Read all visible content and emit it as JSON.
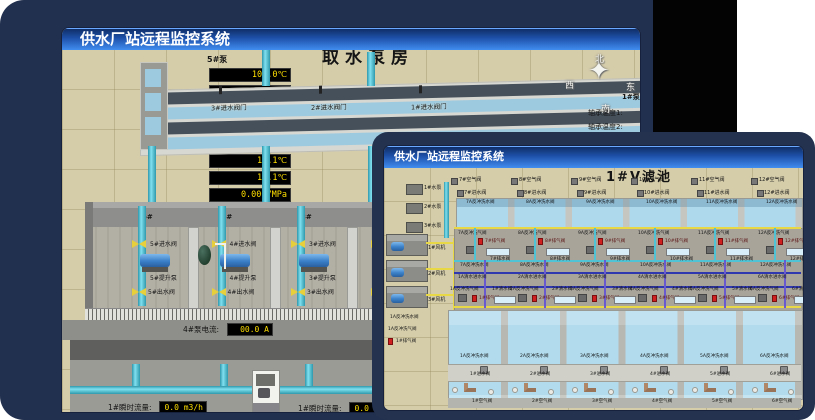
{
  "colors": {
    "desktop_card": "#22304f",
    "black_panel": "#030303",
    "titlebar_top": "#0e2a60",
    "titlebar_bottom": "#418df0",
    "scene_tan": "#d5cdaa",
    "led_text": "#ffdf00",
    "pipe_cyan": "#5bc8d8",
    "valve_yellow": "#e6cf3a",
    "valve_red": "#d02020",
    "pump_blue": "#3a80c8",
    "water": "#b4dcec"
  },
  "back_window": {
    "titlebar": "供水厂站远程监控系统",
    "scene_title": "取水泵房",
    "pump5_panel": {
      "title": "5#泵",
      "rows": [
        {
          "label": "轴承温度1:",
          "value": "100.0℃"
        },
        {
          "label": "轴承温度2:",
          "value": "100.0℃"
        },
        {
          "label": "电机温度1:",
          "value": "18.1℃"
        },
        {
          "label": "电机温度2:",
          "value": "17.9℃"
        },
        {
          "label": "绕组温度1:",
          "value": "18.0℃"
        },
        {
          "label": "绕组温度2:",
          "value": "18.1℃"
        },
        {
          "label": "绕组温度3:",
          "value": "18.1℃"
        },
        {
          "label": "管道压力:",
          "value": "0.0007MPa"
        },
        {
          "label": "多功能阀:",
          "value": "0%"
        }
      ]
    },
    "compass": {
      "n": "北",
      "w": "西",
      "s": "南",
      "e": "东"
    },
    "pump1_panel_partial": {
      "title": "1#泵",
      "row1": "轴承温度1:",
      "row2": "轴承温度2:"
    },
    "inlet_gates": [
      {
        "label": "3#进水阀门"
      },
      {
        "label": "2#进水阀门"
      },
      {
        "label": "1#进水阀门"
      }
    ],
    "bays": [
      {
        "num": "5#",
        "inlet": "5#进水阀",
        "pump": "5#提升泵",
        "outlet": "5#出水阀"
      },
      {
        "num": "4#",
        "inlet": "4#进水阀",
        "pump": "4#提升泵",
        "outlet": "4#出水阀"
      },
      {
        "num": "3#",
        "inlet": "3#进水阀",
        "pump": "3#提升泵",
        "outlet": "3#出水阀"
      },
      {
        "num": "2#",
        "inlet": "2#进水阀",
        "pump": "2#提升泵",
        "outlet": "2#出水阀"
      }
    ],
    "meters": {
      "pump4_current_label": "4#泵电流:",
      "pump4_current_value": "00.0 A",
      "pump2_current_label": "2#泵电流:",
      "pump2_current_value": "00.0 A",
      "flow_left_label": "1#瞬时流量:",
      "flow_left_value": "0.0 m3/h",
      "flow_right_label": "1#瞬时流量:",
      "flow_right_value": "0.0 m3/h"
    }
  },
  "front_window": {
    "titlebar": "供水厂站远程监控系统",
    "scene_title": "1#V滤池",
    "left_pumps": [
      {
        "label": "1#水泵"
      },
      {
        "label": "2#水泵"
      },
      {
        "label": "3#水泵"
      }
    ],
    "left_blowers": [
      {
        "label": "1#风机"
      },
      {
        "label": "2#风机"
      },
      {
        "label": "3#风机"
      }
    ],
    "left_valves": {
      "bw_water": "1A反冲洗水阀",
      "bw_air": "1A反冲洗气阀",
      "vent": "1#排气阀"
    },
    "top_cells": [
      {
        "air": "7#空气阀",
        "inlet": "7#进水阀",
        "bw_water_top": "7A反冲洗水阀",
        "bw_air": "7A反冲洗气阀",
        "vent": "7#排气阀",
        "drain": "7#排水阀",
        "bw_water": "7A反冲洗水阀"
      },
      {
        "air": "8#空气阀",
        "inlet": "8#进水阀",
        "bw_water_top": "8A反冲洗水阀",
        "bw_air": "8A反冲洗气阀",
        "vent": "8#排气阀",
        "drain": "8#排水阀",
        "bw_water": "8A反冲洗水阀"
      },
      {
        "air": "9#空气阀",
        "inlet": "9#进水阀",
        "bw_water_top": "9A反冲洗水阀",
        "bw_air": "9A反冲洗气阀",
        "vent": "9#排气阀",
        "drain": "9#排水阀",
        "bw_water": "9A反冲洗水阀"
      },
      {
        "air": "10#空气阀",
        "inlet": "10#进水阀",
        "bw_water_top": "10A反冲洗水阀",
        "bw_air": "10A反冲洗气阀",
        "vent": "10#排气阀",
        "drain": "10#排水阀",
        "bw_water": "10A反冲洗水阀"
      },
      {
        "air": "11#空气阀",
        "inlet": "11#进水阀",
        "bw_water_top": "11A反冲洗水阀",
        "bw_air": "11A反冲洗气阀",
        "vent": "11#排气阀",
        "drain": "11#排水阀",
        "bw_water": "11A反冲洗水阀"
      },
      {
        "air": "12#空气阀",
        "inlet": "12#进水阀",
        "bw_water_top": "12A反冲洗水阀",
        "bw_air": "12A反冲洗气阀",
        "vent": "12#排气阀",
        "drain": "12#排水阀",
        "bw_water": "12A反冲洗水阀"
      }
    ],
    "bottom_cells": [
      {
        "cw_in": "1A清水进水阀",
        "bw_air": "1A反冲洗气阀",
        "clean": "1#清水阀",
        "vent": "1#排气阀",
        "bw_water": "1A反冲洗水阀",
        "inlet": "1#进水阀",
        "air": "1#空气阀"
      },
      {
        "cw_in": "2A清水进水阀",
        "bw_air": "2A反冲洗气阀",
        "clean": "2#清水阀",
        "vent": "2#排气阀",
        "bw_water": "2A反冲洗水阀",
        "inlet": "2#进水阀",
        "air": "2#空气阀"
      },
      {
        "cw_in": "3A清水进水阀",
        "bw_air": "3A反冲洗气阀",
        "clean": "3#清水阀",
        "vent": "3#排气阀",
        "bw_water": "3A反冲洗水阀",
        "inlet": "3#进水阀",
        "air": "3#空气阀"
      },
      {
        "cw_in": "4A清水进水阀",
        "bw_air": "4A反冲洗气阀",
        "clean": "4#清水阀",
        "vent": "4#排气阀",
        "bw_water": "4A反冲洗水阀",
        "inlet": "4#进水阀",
        "air": "4#空气阀"
      },
      {
        "cw_in": "5A清水进水阀",
        "bw_air": "5A反冲洗气阀",
        "clean": "5#清水阀",
        "vent": "5#排气阀",
        "bw_water": "5A反冲洗水阀",
        "inlet": "5#进水阀",
        "air": "5#空气阀"
      },
      {
        "cw_in": "6A清水进水阀",
        "bw_air": "6A反冲洗气阀",
        "clean": "6#清水阀",
        "vent": "6#排气阀",
        "bw_water": "6A反冲洗水阀",
        "inlet": "6#进水阀",
        "air": "6#空气阀"
      }
    ]
  }
}
